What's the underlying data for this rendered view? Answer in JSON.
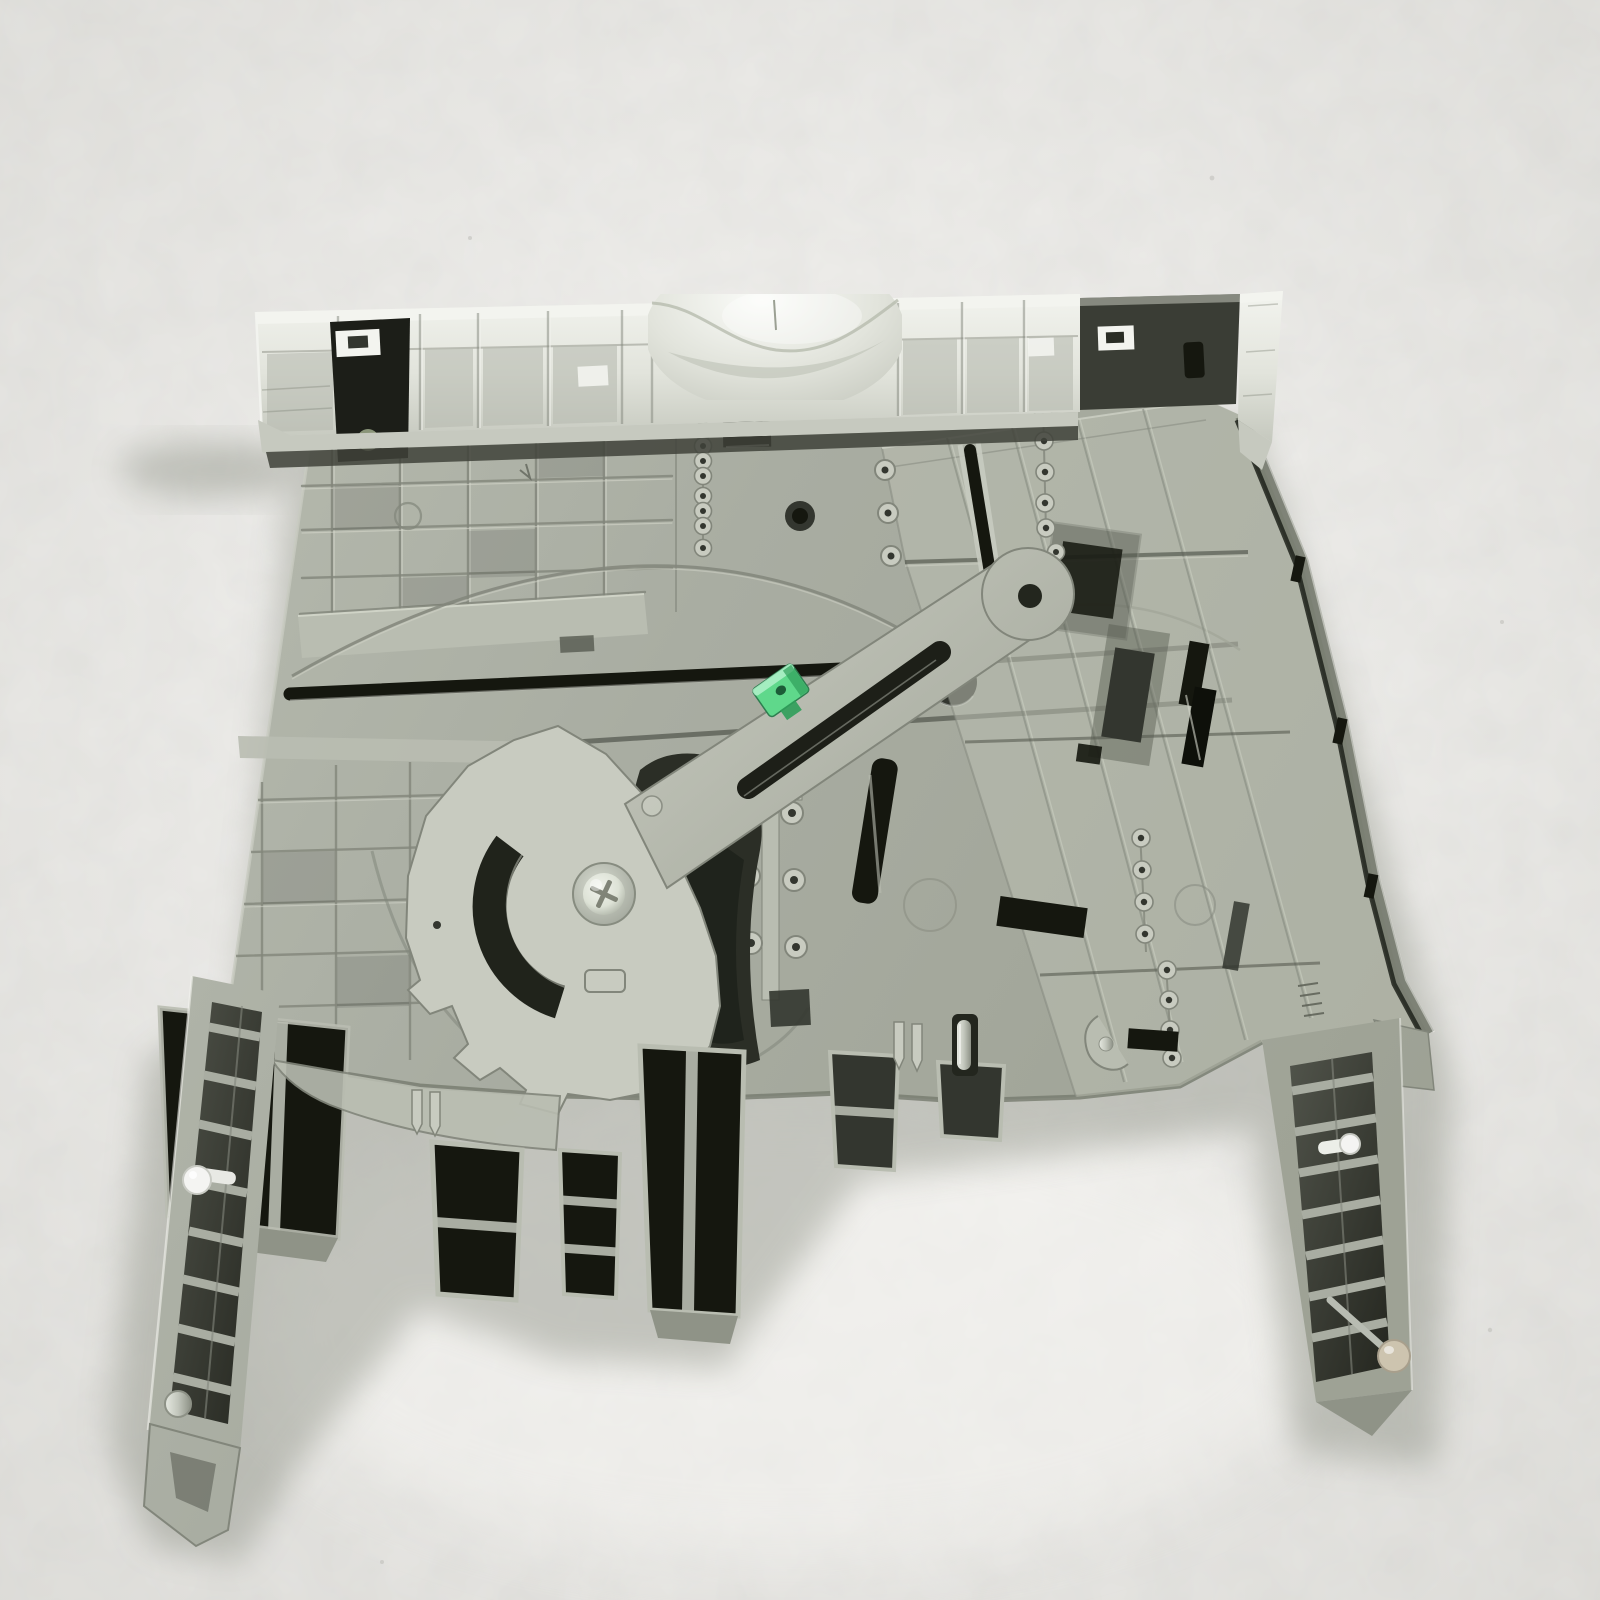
{
  "scene": {
    "subject": "Gray plastic printer paper tray cassette photographed from the underside on an off-white textured studio backdrop",
    "object_type": "printer-paper-tray-part",
    "background": "light mottled paper backdrop",
    "notable_parts": [
      "white ribbed front bezel with curved finger scoop",
      "dark latch pocket at bezel left",
      "dark latch block and white end cap at bezel right",
      "molded rib grid on base panel",
      "horizontal slide channel with black slot",
      "thin molded wire arc",
      "pivoting sector plate with arm and guide slot",
      "green adjuster clip",
      "metal phillips pivot screw",
      "molded bead chains",
      "right guide platform with ridges and dark slots",
      "open rib compartments along bottom edge",
      "left slide rail with white guide roller",
      "right slide rail with white pin and beige end roller",
      "small metal hinge pins"
    ]
  },
  "palette": {
    "bg": "#e8e7e4",
    "bg-edge": "#dbdad6",
    "bg-glow": "#f6f5f2",
    "shadow": "#868a7e",
    "body": "#a9ada2",
    "body-light": "#b9bdb1",
    "body-lighter": "#c8cbc0",
    "body-dark": "#8f9387",
    "body-deep": "#757a6e",
    "rib": "#82867b",
    "rib-hi": "#d3d6ca",
    "recess": "#565a50",
    "recess-deep": "#33362f",
    "black": "#15170f",
    "bezel": "#e2e4dc",
    "bezel-hi": "#f3f4ef",
    "bezel-shade": "#c6c9bf",
    "bezel-cell": "#b7bbb0",
    "seam": "#3f423a",
    "clip-green": "#5fd88b",
    "clip-green-dark": "#2f9e5a",
    "clip-green-light": "#b5f2cd",
    "screw-ring": "#9ba095",
    "screw-face": "#dde2d6",
    "screw-slot": "#6f7366",
    "roller-white": "#f4f4f2",
    "roller-beige": "#cdc4af",
    "metal": "#c2c6bc",
    "metal-dark": "#8d9186"
  }
}
